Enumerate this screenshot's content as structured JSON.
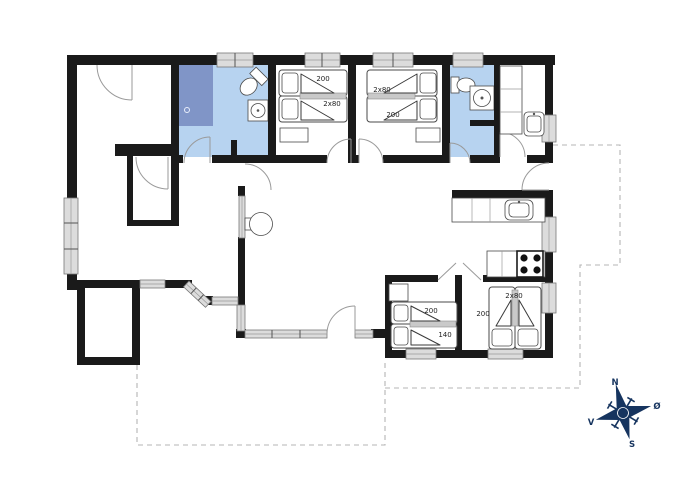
{
  "beds": {
    "bedroom1": [
      "200",
      "2x80"
    ],
    "bedroom2": [
      "2x80",
      "200"
    ],
    "bedroom3": [
      "200",
      "140"
    ],
    "bedroom4": [
      "2x80",
      "200"
    ]
  },
  "compass": {
    "north": "N",
    "east": "Ø",
    "south": "S",
    "west": "V"
  },
  "colors": {
    "wall": "#1a1a1a",
    "bathroom_fill": "#b7d3f0",
    "shower_fill": "#8095c7",
    "window_fill": "#dcdcdc",
    "compass": "#16345f",
    "terrace_dash": "#b4b4b4"
  }
}
